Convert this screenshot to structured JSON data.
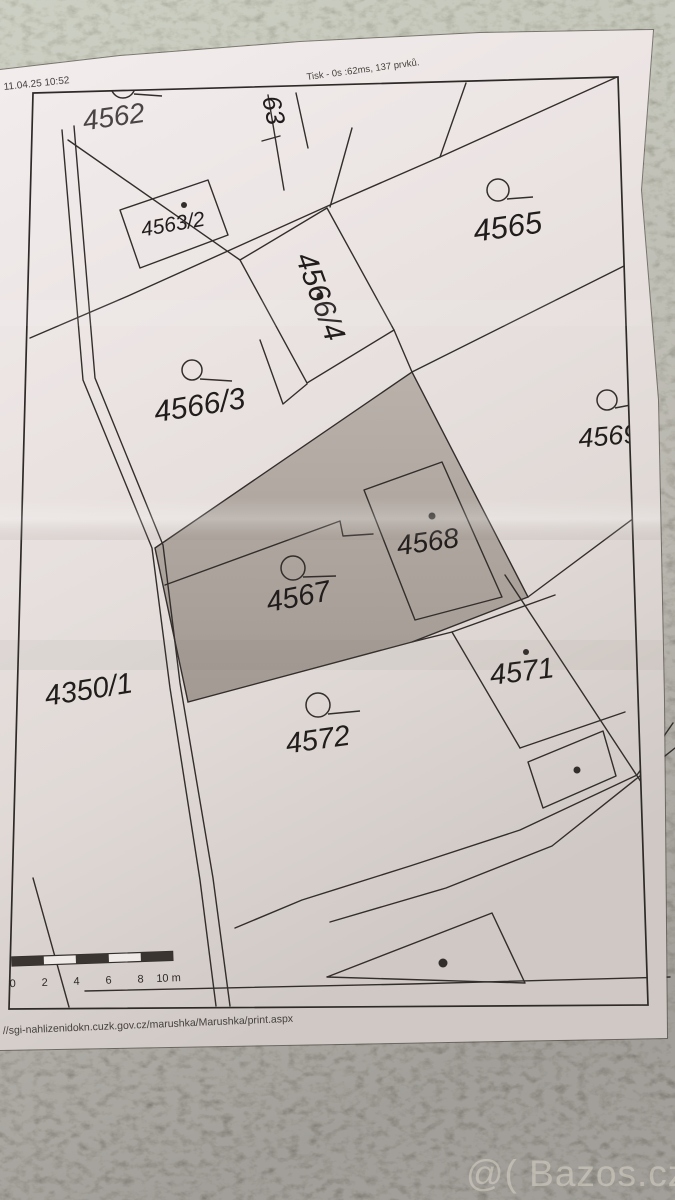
{
  "photo": {
    "watermark_text": "@( Bazos.cz"
  },
  "printout": {
    "timestamp": "11.04.25 10:52",
    "print_info": "Tisk - 0s :62ms, 137 prvků.",
    "footer_url": "//sgi-nahlizenidokn.cuzk.gov.cz/marushka/Marushka/print.aspx",
    "scale_bar": {
      "unit_labels": [
        "0",
        "2",
        "4",
        "6",
        "8",
        "10 m"
      ]
    },
    "parcels": [
      {
        "label": "4562"
      },
      {
        "label": "63"
      },
      {
        "label": "4563/2"
      },
      {
        "label": "4565"
      },
      {
        "label": "4566/4"
      },
      {
        "label": "4566/3"
      },
      {
        "label": "4569"
      },
      {
        "label": "4567"
      },
      {
        "label": "4568"
      },
      {
        "label": "4350/1"
      },
      {
        "label": "4571"
      },
      {
        "label": "4572"
      }
    ],
    "colors": {
      "highlight_fill": "#b3aba4",
      "map_line": "#332e2c",
      "paper": "#ece6e4"
    }
  }
}
